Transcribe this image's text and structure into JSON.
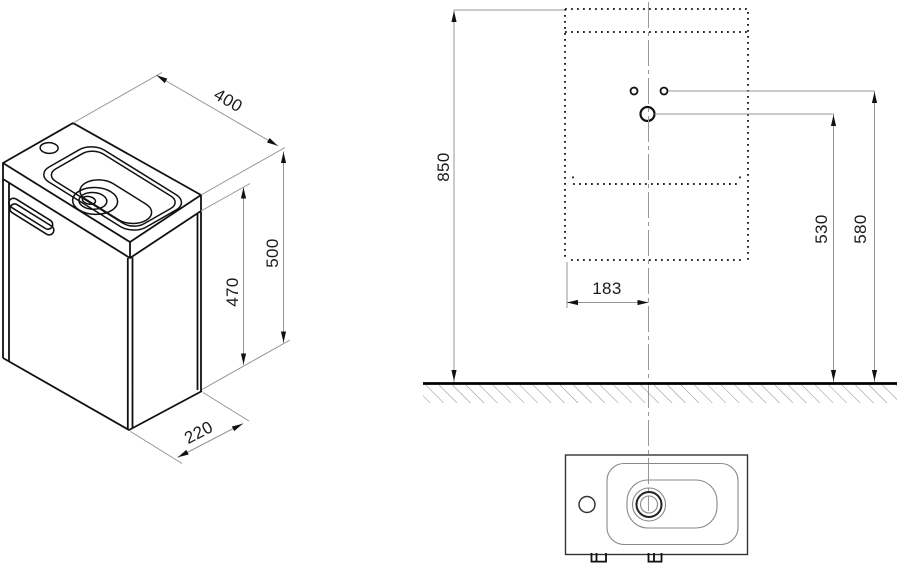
{
  "page": {
    "title": "Washbasin cabinet installation drawing",
    "background": "#ffffff"
  },
  "colors": {
    "line": "#111111",
    "secondary_line": "#333333",
    "light_line": "#888888",
    "dim_line": "#949494",
    "center_line": "#999999",
    "hatch": "#8d8d8d",
    "arrow_fill": "#111111",
    "text": "#1a1a1a"
  },
  "views": {
    "isometric": {
      "name": "isometric cabinet with washbasin",
      "width_mm": "400",
      "total_height_mm": "500",
      "cabinet_height_mm": "470",
      "depth_mm": "220"
    },
    "elevation": {
      "name": "front elevation mounting diagram",
      "top_edge_height_mm": "850",
      "faucet_hole_height_mm": "530",
      "fixing_holes_height_mm": "580",
      "center_offset_mm": "183"
    },
    "top": {
      "name": "basin plan view"
    }
  },
  "dims": {
    "w400": "400",
    "h500": "500",
    "h470": "470",
    "d220": "220",
    "h850": "850",
    "h530": "530",
    "h580": "580",
    "w183": "183"
  }
}
